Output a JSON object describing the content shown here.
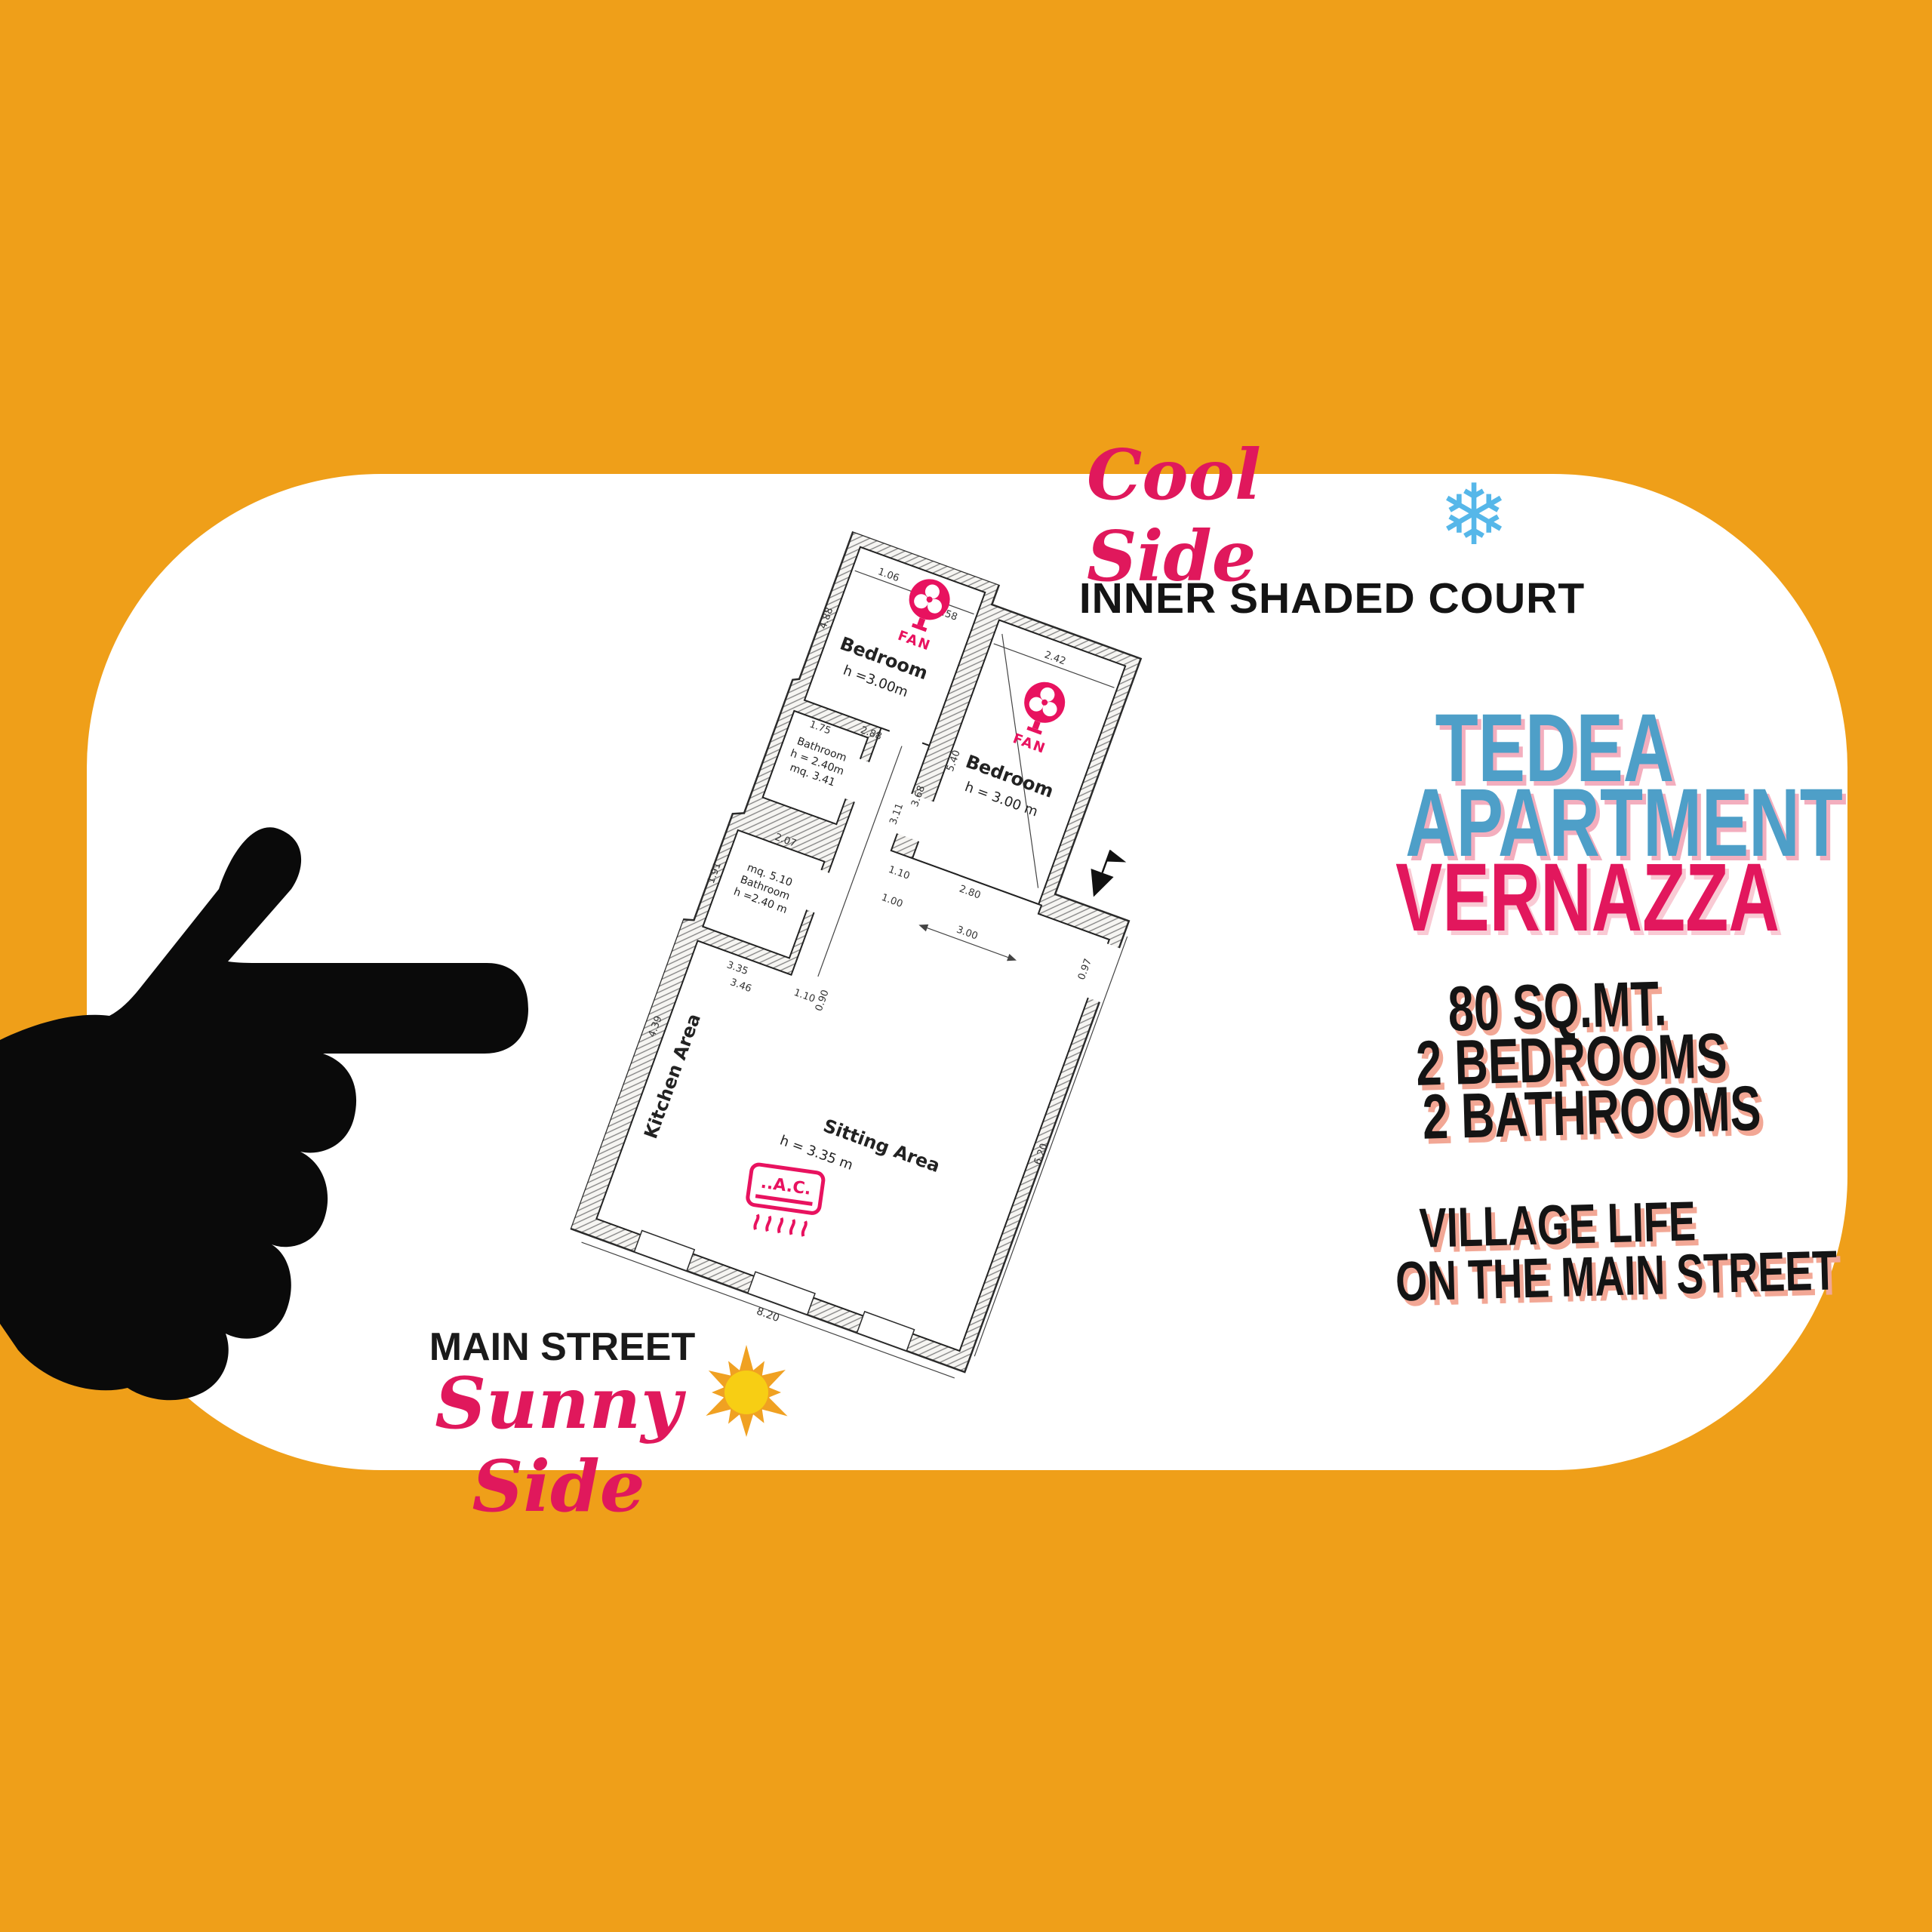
{
  "colors": {
    "background_orange": "#EF9F19",
    "card_white": "#FFFFFF",
    "accent_pink": "#E0185C",
    "accent_blue": "#4E9FC8",
    "snowflake_blue": "#56B7E9",
    "sun_yellow": "#F7CE14",
    "text_black": "#141414"
  },
  "header": {
    "cool_side": "Cool Side",
    "snowflake_icon": "❄",
    "subtitle": "INNER SHADED COURT"
  },
  "title": {
    "line1": "TEDEA",
    "line2": "APARTMENT",
    "line3": "VERNAZZA"
  },
  "stats": {
    "line1": "80 SQ.MT.",
    "line2": "2 BEDROOMS",
    "line3": "2 BATHROOMS"
  },
  "tagline": {
    "line1": "VILLAGE LIFE",
    "line2": "ON THE MAIN STREET"
  },
  "footer": {
    "label": "MAIN STREET",
    "script": "Sunny Side"
  },
  "floor_plan": {
    "bedroom1": {
      "name": "Bedroom",
      "height": "h =3.00m"
    },
    "bedroom2": {
      "name": "Bedroom",
      "height": "h = 3.00 m"
    },
    "bathroom1": {
      "name": "Bathroom",
      "height": "h = 2.40m",
      "area": "mq. 3.41"
    },
    "bathroom2": {
      "area": "mq. 5.10",
      "name": "Bathroom",
      "height": "h =2.40 m"
    },
    "kitchen": {
      "name": "Kitchen Area"
    },
    "sitting": {
      "name": "Sitting Area",
      "height": "h = 3.35 m"
    },
    "fan_label": "FAN",
    "ac_label": "..A.C.",
    "dims": {
      "d106": "1.06",
      "d158": "1.58",
      "d242": "2.42",
      "d488": "4.88",
      "d368": "3.68",
      "d540": "5.40",
      "d288": "2.88",
      "d175": "1.75",
      "d207": "2.07",
      "d191": "1.91",
      "d335": "3.35",
      "d346": "3.46",
      "d311": "3.11",
      "d110a": "1.10",
      "d100": "1.00",
      "d110b": "1.10",
      "d090": "0.90",
      "d280": "2.80",
      "d300": "3.00",
      "d097": "0.97",
      "d620": "6.20",
      "d820": "8.20",
      "d439": "4.39"
    }
  }
}
